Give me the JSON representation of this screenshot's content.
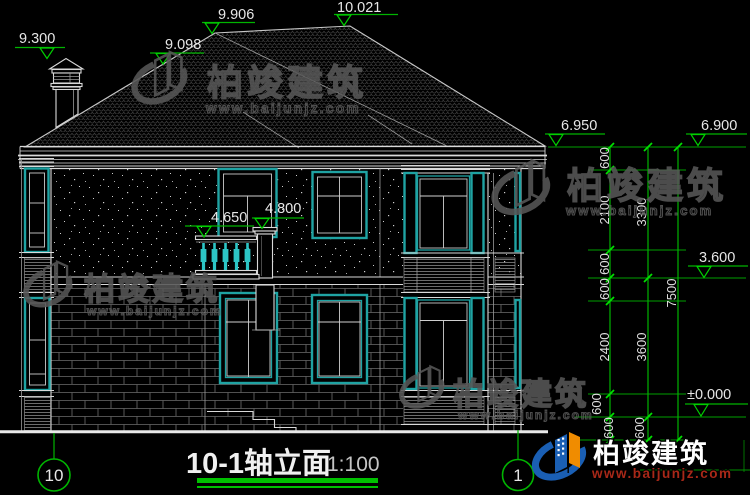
{
  "drawing": {
    "title": "10-1轴立面",
    "scale": "1:100",
    "axis_left": "10",
    "axis_right": "1"
  },
  "elevations": {
    "chimney_top": "9.300",
    "left_hip": "9.098",
    "ridge_left": "9.906",
    "ridge_right": "10.021",
    "eave": "6.950",
    "wall_top": "6.900",
    "balcony_rail": "4.650",
    "balcony_pillar": "4.800",
    "second_floor": "3.600",
    "first_floor": "±0.000"
  },
  "dims": {
    "inner": [
      "600",
      "2100",
      "600",
      "600",
      "2400",
      "600",
      "600"
    ],
    "middle": [
      "3300",
      "3600",
      "600"
    ],
    "outer": [
      "7500"
    ]
  },
  "watermark": {
    "brand": "柏竣建筑",
    "url": "www.baijunjz.com"
  },
  "colors": {
    "background": "#000000",
    "lines": "#d9d9d9",
    "windows": "#1fa3a3",
    "dimensions": "#00b400",
    "watermark_gray": "#575757",
    "logo_blue": "#1a5fb4",
    "logo_orange": "#f08c00"
  }
}
